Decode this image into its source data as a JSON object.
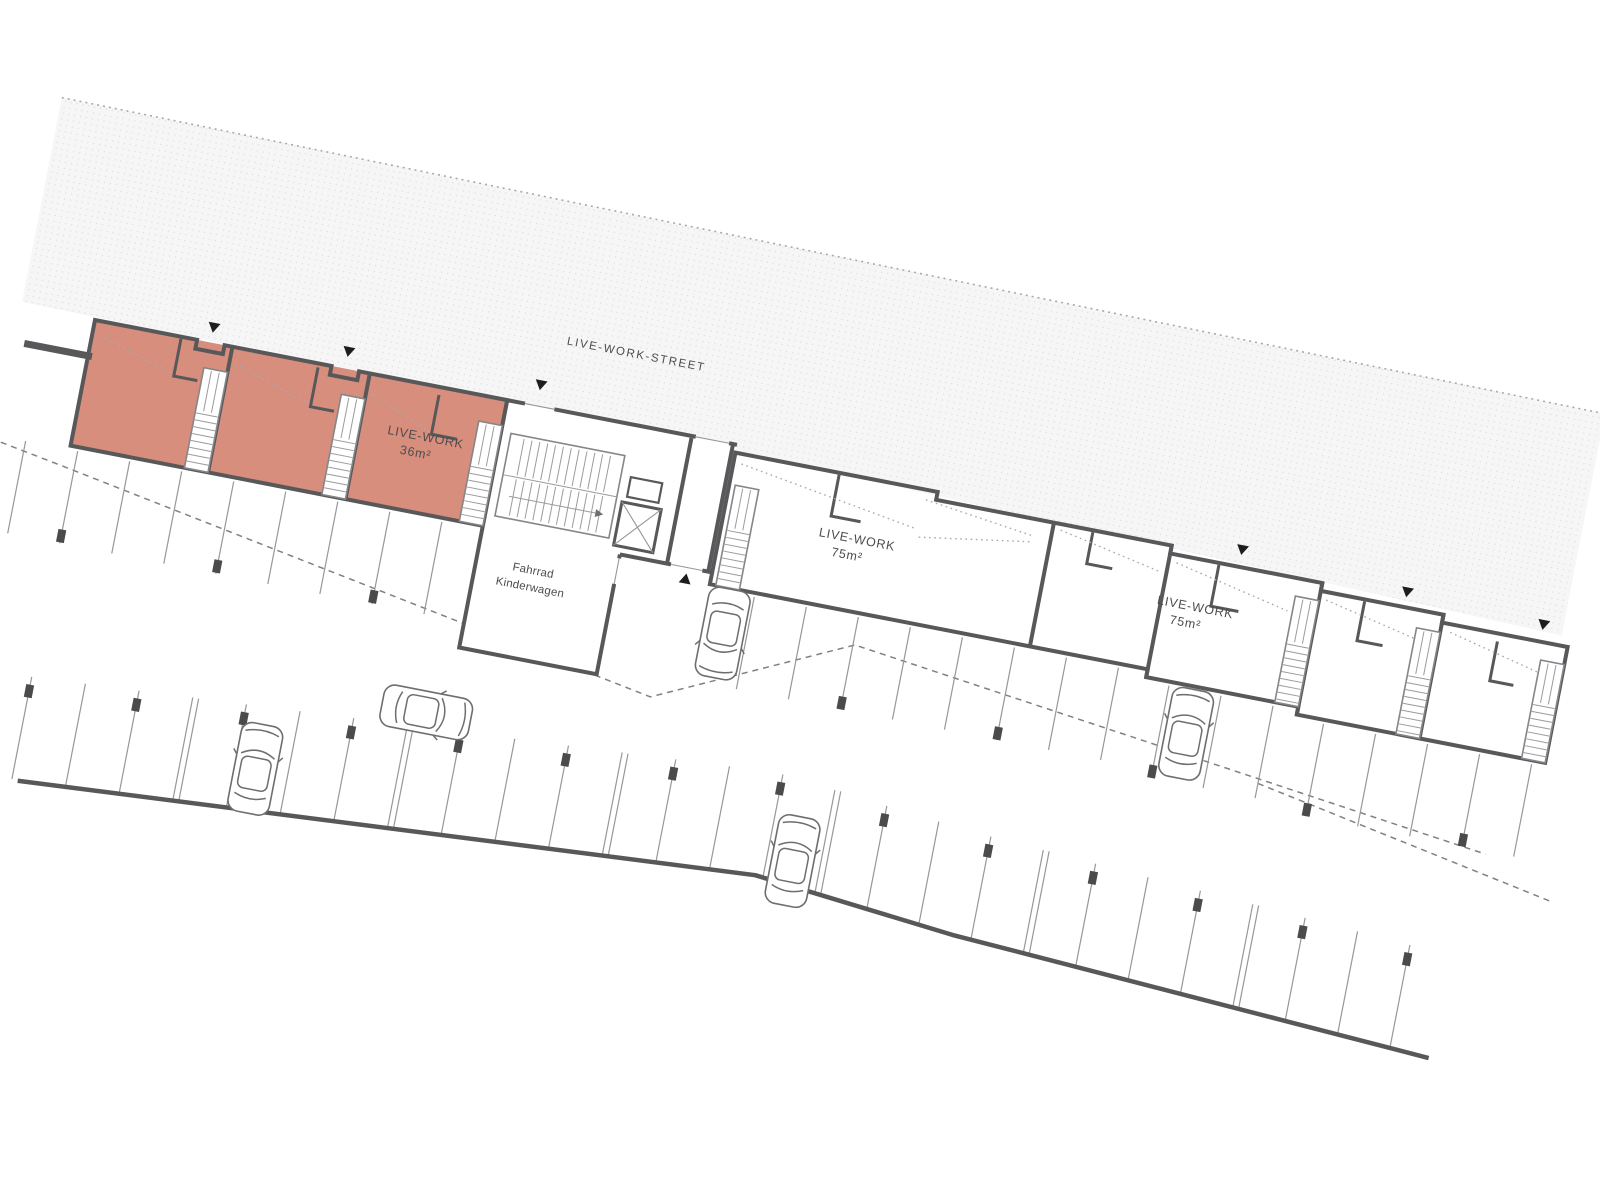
{
  "labels": {
    "street": "LIVE-WORK-STREET",
    "unit_36": {
      "name": "LIVE-WORK",
      "area": "36m²"
    },
    "unit_75_a": {
      "name": "LIVE-WORK",
      "area": "75m²"
    },
    "unit_75_b": {
      "name": "LIVE-WORK",
      "area": "75m²"
    },
    "storage": {
      "line1": "Fahrrad",
      "line2": "Kinderwagen"
    }
  },
  "colors": {
    "unit_fill": "#d78e7d",
    "wall": "#58585a",
    "line": "#97979a",
    "dashed": "#818184",
    "dotted": "#a9a9ac",
    "text": "#4c4c4e",
    "street_fill": "#f6f6f7",
    "street_dot": "#dededf",
    "stop_fill": "#4b4b4d",
    "white": "#ffffff"
  },
  "geometry": {
    "rotation_deg": 11,
    "origin": [
      95,
      320
    ],
    "street_boundary": [
      [
        -75,
        -212
      ],
      [
        1500,
        -196
      ]
    ],
    "site_boundary": [
      [
        12,
        467
      ],
      [
        754,
        419
      ],
      [
        959,
        440
      ],
      [
        1450,
        470
      ]
    ],
    "overhang_dashed": [
      [
        [
          -80,
          136
        ],
        [
          -7,
          149
        ],
        [
          617,
          264
        ],
        [
          808,
          174
        ],
        [
          1467,
          259
        ]
      ],
      [
        [
          1230,
          233
        ],
        [
          1540,
          293
        ]
      ]
    ],
    "parking": {
      "upper_left": {
        "y": 132,
        "len": 94,
        "xs": [
          -45,
          8,
          61,
          114,
          167,
          220,
          273,
          326,
          379
        ],
        "stops": [
          8,
          167,
          326
        ]
      },
      "upper_right": {
        "len": 94,
        "cols": [
          [
            700,
            144
          ],
          [
            753,
            144
          ],
          [
            806,
            144
          ],
          [
            859,
            144
          ],
          [
            912,
            144
          ],
          [
            965,
            144
          ],
          [
            1018,
            144
          ],
          [
            1071,
            144
          ],
          [
            1124,
            152
          ],
          [
            1177,
            152
          ],
          [
            1230,
            152
          ],
          [
            1283,
            160
          ],
          [
            1336,
            160
          ],
          [
            1389,
            160
          ],
          [
            1442,
            160
          ],
          [
            1495,
            160
          ]
        ],
        "stops": [
          806,
          965,
          1124,
          1283,
          1442
        ]
      },
      "lower": {
        "len": 105,
        "xs": [
          6,
          60,
          114,
          168,
          222,
          276,
          330,
          384,
          438,
          492,
          546,
          600,
          654,
          708,
          762,
          816,
          870,
          924,
          978,
          1032,
          1086,
          1140,
          1194,
          1248,
          1302,
          1356,
          1410
        ],
        "stops_every": 2,
        "doubles_every": 4
      }
    },
    "stairs": [
      {
        "x": 116,
        "y": 26,
        "w": 24,
        "h": 102
      },
      {
        "x": 256,
        "y": 26,
        "w": 24,
        "h": 102
      },
      {
        "x": 396,
        "y": 26,
        "w": 24,
        "h": 102
      },
      {
        "x": 660,
        "y": 40,
        "w": 24,
        "h": 102
      },
      {
        "x": 1231,
        "y": 42,
        "w": 24,
        "h": 108
      },
      {
        "x": 1356,
        "y": 50,
        "w": 24,
        "h": 108
      },
      {
        "x": 1484,
        "y": 58,
        "w": 24,
        "h": 100
      },
      {
        "x": 430,
        "y": 32,
        "w": 116,
        "h": 84,
        "type": "main"
      }
    ],
    "cars": [
      {
        "x": 676,
        "y": 188,
        "rot": 180
      },
      {
        "x": 243,
        "y": 410,
        "rot": 0
      },
      {
        "x": 400,
        "y": 322,
        "rot": 90
      },
      {
        "x": 788,
        "y": 398,
        "rot": 0
      },
      {
        "x": 1150,
        "y": 198,
        "rot": 0
      }
    ],
    "arrows_down": [
      [
        118,
        -10
      ],
      [
        255,
        -12
      ],
      [
        450,
        -16
      ],
      [
        1170,
        12
      ],
      [
        1340,
        22
      ],
      [
        1480,
        28
      ]
    ],
    "arrows_up": [
      [
        629,
        146
      ]
    ]
  }
}
